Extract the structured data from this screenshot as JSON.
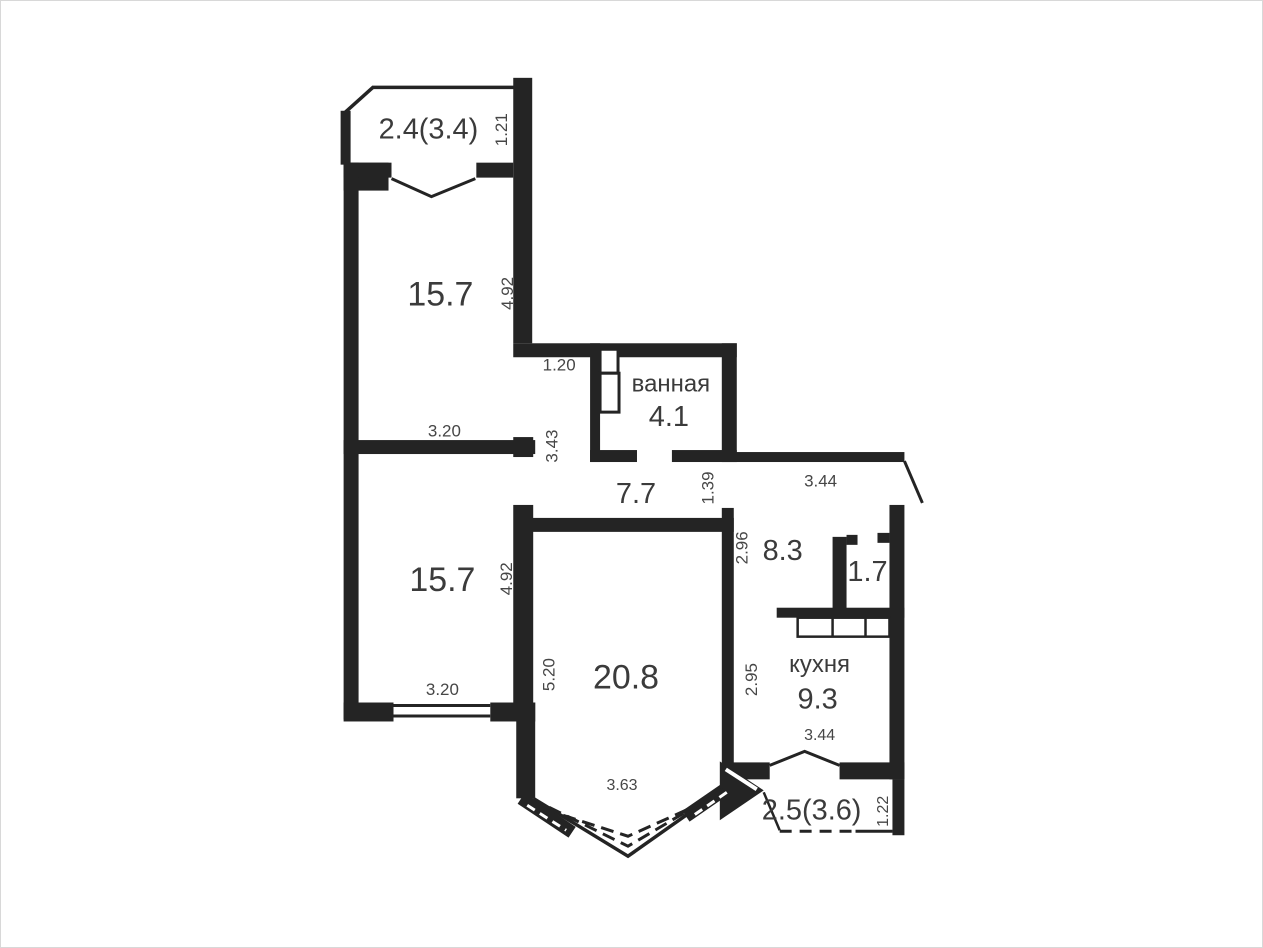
{
  "colors": {
    "wall": "#242424",
    "text": "#3b3b3b",
    "dim": "#464646",
    "paper": "#ffffff",
    "frame": "#d8d8d8"
  },
  "plan": {
    "balcony_top": {
      "area": "2.4(3.4)",
      "depth": "1.21"
    },
    "room_top": {
      "area": "15.7",
      "height": "4.92",
      "width": "3.20"
    },
    "niche": {
      "width": "1.20",
      "height": "3.43"
    },
    "bathroom": {
      "name": "ванная",
      "area": "4.1"
    },
    "hall": {
      "area": "7.7",
      "width": "1.39"
    },
    "entry": {
      "area": "8.3",
      "height": "2.96",
      "top_width": "3.44"
    },
    "closet": {
      "area": "1.7"
    },
    "room_bottom": {
      "area": "15.7",
      "height": "4.92",
      "width": "3.20"
    },
    "living": {
      "area": "20.8",
      "height": "5.20",
      "bay_width": "3.63"
    },
    "kitchen": {
      "name": "кухня",
      "area": "9.3",
      "height": "2.95",
      "width": "3.44"
    },
    "balcony_bottom": {
      "area": "2.5(3.6)",
      "depth": "1.22"
    }
  }
}
